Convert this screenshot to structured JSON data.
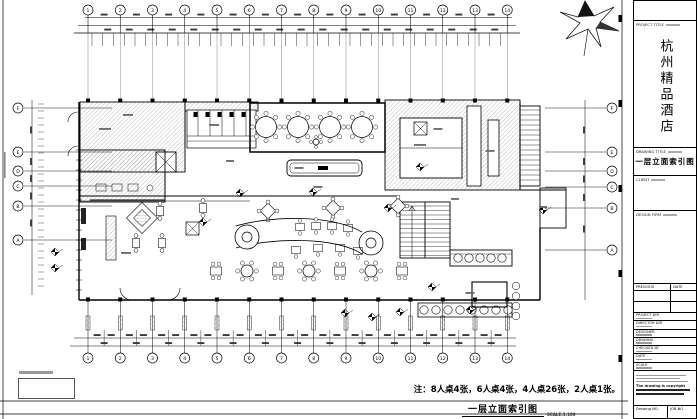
{
  "sheet": {
    "note": "注：8人桌4张，6人桌4张，4人桌26张，2人桌1张。",
    "bottom_title": "一层立面索引图",
    "bottom_scale": "SCALE:1:100"
  },
  "grid": {
    "top_numbers": [
      "1",
      "2",
      "3",
      "4",
      "5",
      "6",
      "7",
      "8",
      "9",
      "10",
      "11",
      "12",
      "13",
      "14"
    ],
    "bottom_numbers": [
      "1",
      "2",
      "3",
      "4",
      "5",
      "6",
      "7",
      "8",
      "9",
      "10",
      "11",
      "12",
      "13",
      "14"
    ],
    "left_letters": [
      "F",
      "E",
      "D",
      "C",
      "B",
      "A"
    ],
    "right_letters": [
      "F",
      "E",
      "D",
      "C",
      "B",
      "A"
    ]
  },
  "title_block": {
    "project_title_label": "PROJECT TITLE",
    "project_title": "杭州精品酒店",
    "drawing_title_label": "DRAWING TITLE",
    "drawing_title": "一层立面索引图",
    "client_label": "CLIENT",
    "design_firm_label": "DESIGN FIRM",
    "revision_headers": [
      "PREVIOUS",
      "DATE"
    ],
    "fields": [
      {
        "label": "PROJECT DIR"
      },
      {
        "label": "DIRECTOR DIR"
      },
      {
        "label": "DESIGNER"
      },
      {
        "label": "DRAWING"
      },
      {
        "label": "CHECKED BY"
      },
      {
        "label": "DATE"
      },
      {
        "label": "SCALE"
      }
    ],
    "copyright_line": "The drawing is copyright",
    "drawing_no_label": "Drawing NO.",
    "job_no_label": "JOB NO."
  }
}
